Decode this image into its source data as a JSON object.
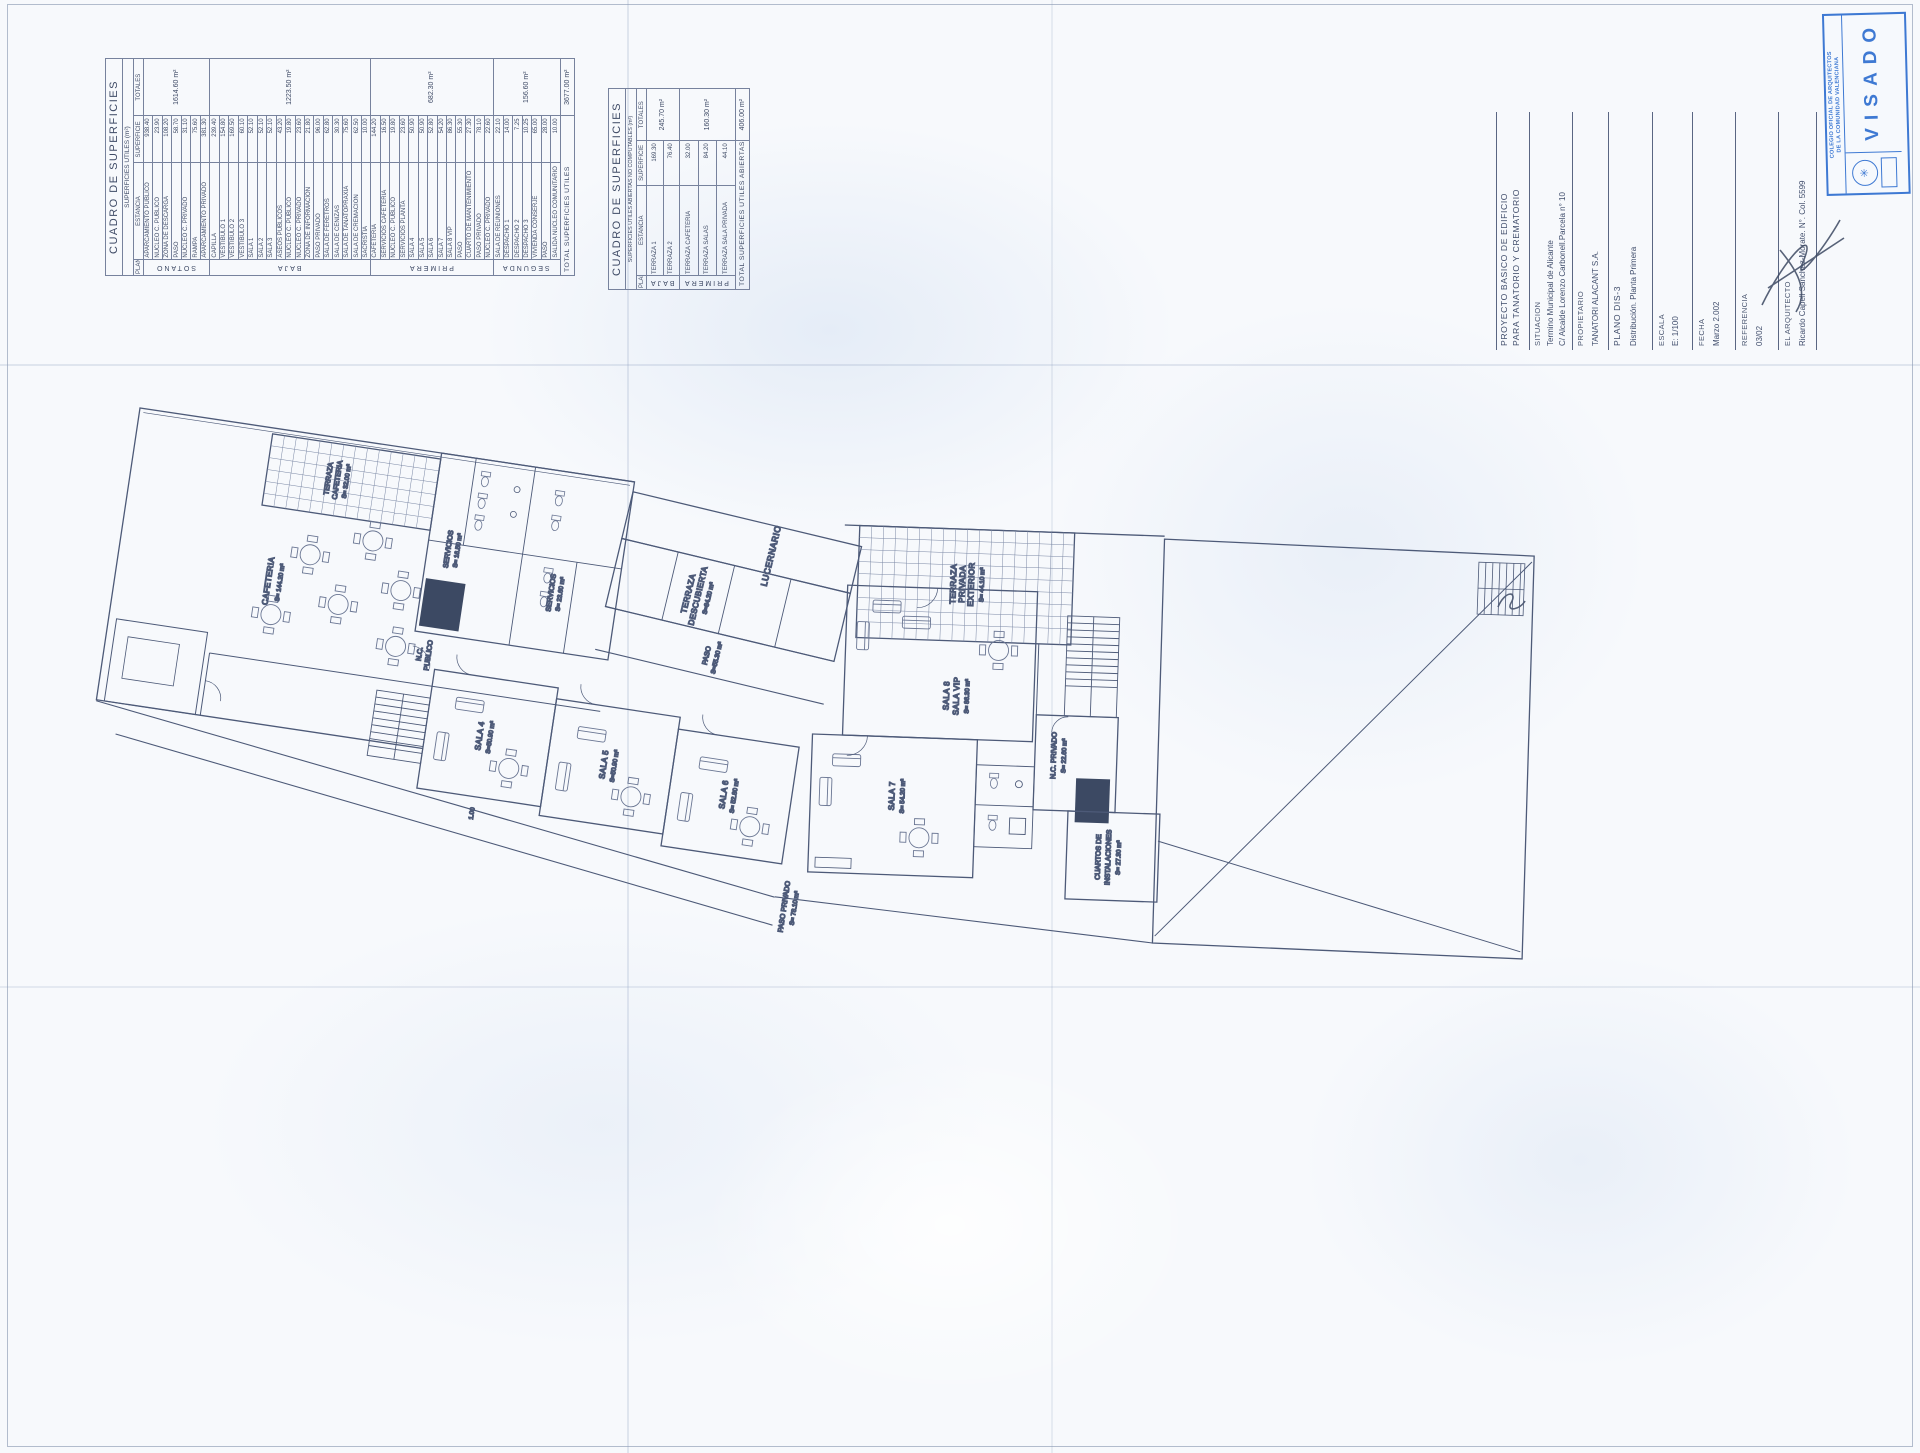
{
  "meta": {
    "line_color": "#4d5a78",
    "stamp_color": "#2f6fd0",
    "paper_color": "#f7f9fc"
  },
  "tables": {
    "utiles": {
      "title": "CUADRO DE SUPERFICIES",
      "subtitle": "SUPERFICIES UTILES (m²)",
      "columns": [
        "PLANTA",
        "ESTANCIA",
        "SUPERFICIE",
        "TOTALES"
      ],
      "groups": [
        {
          "planta": "SOTANO",
          "total": "1614.60 m²",
          "rows": [
            [
              "APARCAMIENTO PUBLICO",
              "938.40"
            ],
            [
              "NUCLEO C. PUBLICO",
              "23.90"
            ],
            [
              "ZONA DE DESCARGA",
              "108.20"
            ],
            [
              "PASO",
              "58.70"
            ],
            [
              "NUCLEO C. PRIVADO",
              "31.10"
            ],
            [
              "RAMPA",
              "75.60"
            ],
            [
              "APARCAMIENTO PRIVADO",
              "381.30"
            ]
          ]
        },
        {
          "planta": "BAJA",
          "total": "1223.50 m²",
          "rows": [
            [
              "CAPILLA",
              "239.40"
            ],
            [
              "VESTIBULO 1",
              "154.80"
            ],
            [
              "VESTIBULO 2",
              "169.50"
            ],
            [
              "VESTIBULO 3",
              "60.10"
            ],
            [
              "SALA 1",
              "52.10"
            ],
            [
              "SALA 2",
              "52.10"
            ],
            [
              "SALA 3",
              "52.10"
            ],
            [
              "ASEOS PUBLICOS",
              "43.20"
            ],
            [
              "NUCLEO C. PUBLICO",
              "19.80"
            ],
            [
              "NUCLEO C. PRIVADO",
              "23.60"
            ],
            [
              "ZONA DE INFORMACION",
              "21.80"
            ],
            [
              "PASO PRIVADO",
              "96.00"
            ],
            [
              "SALA DE FERETROS",
              "62.80"
            ],
            [
              "SALA DE CENIZAS",
              "30.30"
            ],
            [
              "SALA DE TANATOPRAXIA",
              "75.60"
            ],
            [
              "SALA DE CREMACION",
              "62.50"
            ],
            [
              "SACRISTIA",
              "10.00"
            ]
          ]
        },
        {
          "planta": "PRIMERA",
          "total": "682.30 m²",
          "rows": [
            [
              "CAFETERIA",
              "144.20"
            ],
            [
              "SERVICIOS CAFETERIA",
              "16.50"
            ],
            [
              "NUCLEO C. PUBLICO",
              "19.80"
            ],
            [
              "SERVICIOS PLANTA",
              "23.60"
            ],
            [
              "SALA 4",
              "50.90"
            ],
            [
              "SALA 5",
              "50.90"
            ],
            [
              "SALA 6",
              "52.80"
            ],
            [
              "SALA 7",
              "54.20"
            ],
            [
              "SALA 8 VIP",
              "86.30"
            ],
            [
              "PASO",
              "55.30"
            ],
            [
              "CUARTO DE MANTENIMIENTO",
              "27.30"
            ],
            [
              "PASO PRIVADO",
              "78.10"
            ],
            [
              "NUCLEO C. PRIVADO",
              "22.60"
            ]
          ]
        },
        {
          "planta": "SEGUNDA",
          "total": "156.60 m²",
          "rows": [
            [
              "SALA DE REUNIONES",
              "22.10"
            ],
            [
              "DESPACHO 1",
              "14.00"
            ],
            [
              "DESPACHO 2",
              "7.25"
            ],
            [
              "DESPACHO 3",
              "10.25"
            ],
            [
              "VIVIENDA CONSERJE",
              "65.00"
            ],
            [
              "PASO",
              "28.00"
            ],
            [
              "SALIDA NUCLEO COMUNITARIO",
              "10.00"
            ]
          ]
        }
      ],
      "total_label": "TOTAL SUPERFICIES UTILES",
      "total_value": "3677.00 m²"
    },
    "abiertas": {
      "title": "CUADRO DE SUPERFICIES",
      "subtitle": "SUPERFICIES UTILES ABIERTAS  NO COMPUTABLES (m²)",
      "columns": [
        "PLANTA",
        "ESTANCIA",
        "SUPERFICIE",
        "TOTALES"
      ],
      "groups": [
        {
          "planta": "BAJA",
          "total": "245.70 m²",
          "rows": [
            [
              "TERRAZA 1",
              "169.30"
            ],
            [
              "TERRAZA 2",
              "76.40"
            ]
          ]
        },
        {
          "planta": "PRIMERA",
          "total": "160.30 m²",
          "rows": [
            [
              "TERRAZA CAFETERIA",
              "32.00"
            ],
            [
              "TERRAZA SALAS",
              "84.20"
            ],
            [
              "TERRAZA SALA PRIVADA",
              "44.10"
            ]
          ]
        }
      ],
      "total_label": "TOTAL SUPERFICIES UTILES ABIERTAS",
      "total_value": "406.00 m²"
    }
  },
  "title_block": {
    "project_line1": "PROYECTO BASICO DE EDIFICIO",
    "project_line2": "PARA TANATORIO Y CREMATORIO",
    "situacion_label": "SITUACION",
    "situacion_line1": "Termino Municipal de Alicante",
    "situacion_line2": "C/ Alcalde Lorenzo Carbonell.Parcela n° 10",
    "propietario_label": "PROPIETARIO",
    "propietario_value": "TANATORI ALACANT S.A.",
    "plano_label": "PLANO DIS-3",
    "plano_value": "Distribución. Planta Primera",
    "escala_label": "ESCALA",
    "escala_value": "E: 1/100",
    "fecha_label": "FECHA",
    "fecha_value": "Marzo 2.002",
    "referencia_label": "REFERENCIA",
    "referencia_value": "03/02",
    "arquitecto_label": "EL ARQUITECTO",
    "arquitecto_value": "Ricardo Capell Sanchez-Morate. N°. Col. 5599"
  },
  "stamp": {
    "org_line1": "COLEGIO OFICIAL DE ARQUITECTOS",
    "org_line2": "DE LA COMUNIDAD VALENCIANA",
    "word": "VISADO",
    "logo": "arquitectos-emblem"
  },
  "plan": {
    "labels": {
      "terraza_cafeteria_1": "TERRAZA",
      "terraza_cafeteria_2": "CAFETERIA",
      "terraza_cafeteria_s": "S= 32.00 m²",
      "cafeteria_1": "CAFETERIA",
      "cafeteria_s": "S= 144.20 m²",
      "servicios_a": "SERVICIOS",
      "servicios_a_s": "S= 16.50 m²",
      "servicios_b": "SERVICIOS",
      "servicios_b_s": "S= 23.60 m²",
      "nc_publico_1": "N.C.",
      "nc_publico_2": "PUBLICO",
      "lucernario": "LUCERNARIO",
      "terraza_desc_1": "TERRAZA",
      "terraza_desc_2": "DESCUBIERTA",
      "terraza_desc_s": "S=84.20 m²",
      "paso": "PASO",
      "paso_s": "S=55.30 m²",
      "sala4": "SALA 4",
      "sala4_s": "S=50.90 m²",
      "sala5": "SALA 5",
      "sala5_s": "S=50.90 m²",
      "sala6": "SALA 6",
      "sala6_s": "S= 52.80 m²",
      "sala7": "SALA 7",
      "sala7_s": "S= 54.20 m²",
      "sala8_1": "SALA 8",
      "sala8_2": "SALA VIP",
      "sala8_s": "S= 86.30 m²",
      "terraza_priv_1": "TERRAZA",
      "terraza_priv_2": "PRIVADA",
      "terraza_priv_3": "EXTERIOR",
      "terraza_priv_s": "S= 44.10 m²",
      "nc_privado": "N.C. PRIVADO",
      "nc_privado_s": "S= 22.60 m²",
      "cuartos_1": "CUARTOS DE",
      "cuartos_2": "INSTALACIONES",
      "cuartos_s": "S= 27.30 m²",
      "paso_privado": "PASO PRIVADO",
      "paso_privado_s": "S= 78.10 m²",
      "dim_1": "1.00"
    }
  }
}
